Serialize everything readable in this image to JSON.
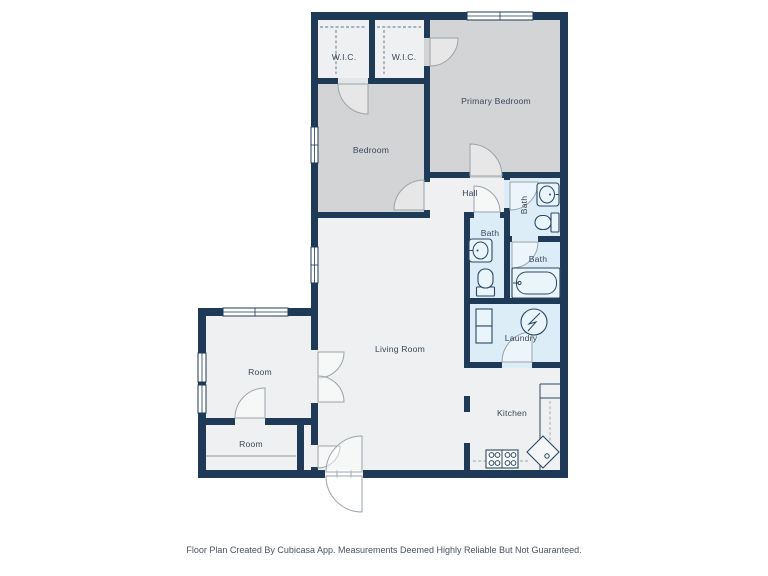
{
  "document": {
    "type": "floor-plan",
    "creator_note": "Floor Plan Created By Cubicasa App. Measurements Deemed Highly Reliable But Not Guaranteed."
  },
  "rooms": {
    "wic_left": {
      "label": "W.I.C."
    },
    "wic_right": {
      "label": "W.I.C."
    },
    "primary_bedroom": {
      "label": "Primary Bedroom"
    },
    "bedroom": {
      "label": "Bedroom"
    },
    "hall": {
      "label": "Hall"
    },
    "bath_ensuite": {
      "label": "Bath"
    },
    "bath_hall": {
      "label": "Bath"
    },
    "bath_tub": {
      "label": "Bath"
    },
    "laundry": {
      "label": "Laundry"
    },
    "living_room": {
      "label": "Living Room"
    },
    "kitchen": {
      "label": "Kitchen"
    },
    "room_upper": {
      "label": "Room"
    },
    "room_lower": {
      "label": "Room"
    }
  },
  "fixture_icons": [
    "sink-icon",
    "toilet-icon",
    "bathtub-icon",
    "washer-icon",
    "stove-icon",
    "kitchen-sink-icon",
    "cabinet-icon",
    "door-arc-icon",
    "window-icon"
  ],
  "colors": {
    "wall": "#1e3a57",
    "room-gray": "#d3d4d6",
    "room-light": "#eef0f1",
    "bath-blue": "#ddedf8",
    "door": "#9aa3ab",
    "text": "#3a4757",
    "bg": "#ffffff"
  }
}
